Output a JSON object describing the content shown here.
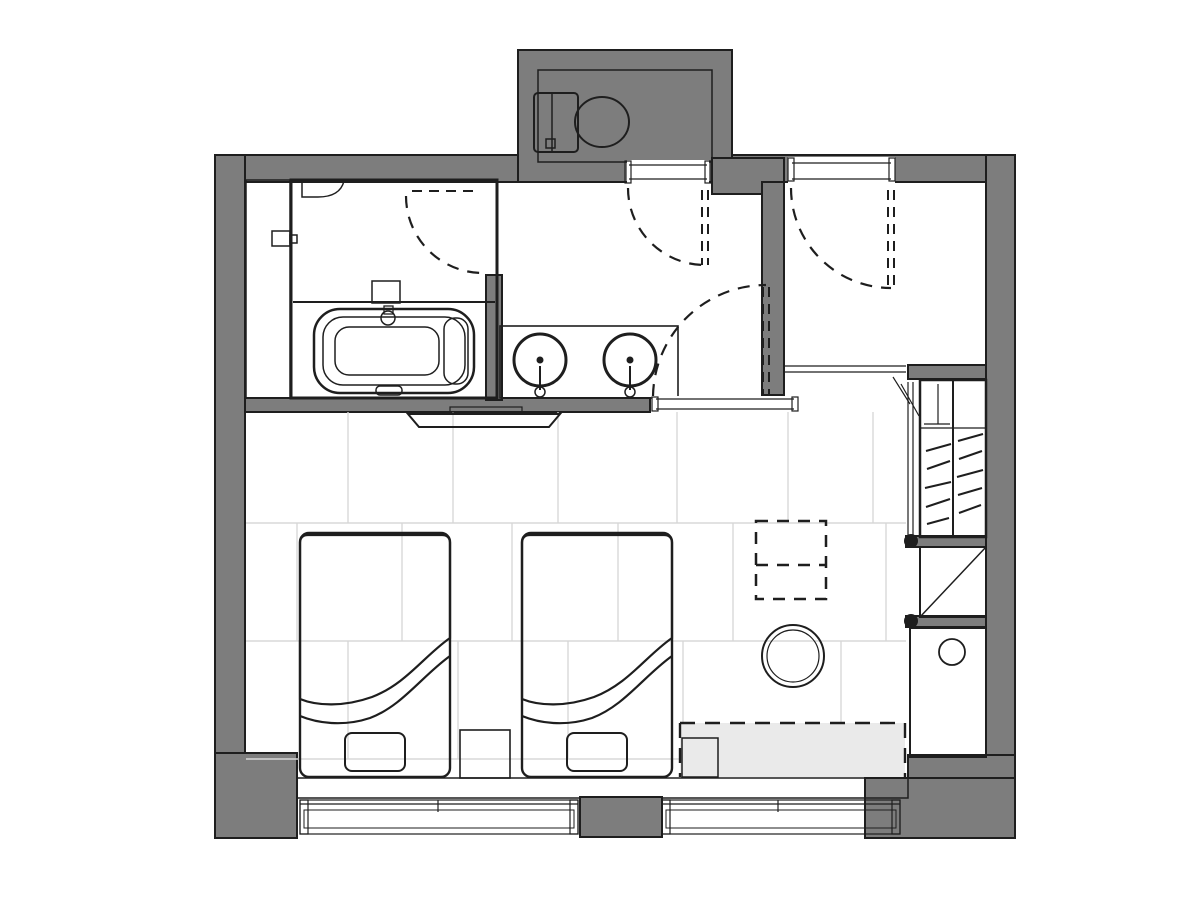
{
  "plan": {
    "kind": "hotel-guestroom-floor-plan",
    "canvas": {
      "width": 1200,
      "height": 900
    },
    "rooms": [
      {
        "name": "toilet-room"
      },
      {
        "name": "unit-bathroom-with-tub-and-shower"
      },
      {
        "name": "vanity-washroom"
      },
      {
        "name": "entry-hall"
      },
      {
        "name": "wardrobe-closet"
      },
      {
        "name": "kitchenette-counter"
      },
      {
        "name": "twin-bedroom"
      }
    ],
    "fixtures": [
      {
        "name": "toilet"
      },
      {
        "name": "bathtub"
      },
      {
        "name": "shower-control"
      },
      {
        "name": "vanity-counter-two-sinks"
      },
      {
        "name": "wall-mounted-tv"
      },
      {
        "name": "twin-bed-left"
      },
      {
        "name": "twin-bed-right"
      },
      {
        "name": "nightstand"
      },
      {
        "name": "round-table"
      },
      {
        "name": "overhead-cabinet-dashed"
      },
      {
        "name": "window-bench-dashed"
      },
      {
        "name": "clothes-hangers"
      },
      {
        "name": "luggage-rack"
      },
      {
        "name": "counter-sink"
      },
      {
        "name": "entry-door-swing"
      },
      {
        "name": "toilet-door-swing"
      },
      {
        "name": "bathroom-door-swing"
      },
      {
        "name": "vanity-door-swing"
      },
      {
        "name": "window-left"
      },
      {
        "name": "window-right"
      }
    ]
  },
  "colors": {
    "page_bg": "#ffffff",
    "wall": "#7d7d7d",
    "line": "#1e1e1e",
    "floor_light": "#eaeaea",
    "white": "#ffffff",
    "duvet": "#b5b5b5",
    "pillow": "#efefef",
    "sill": "#b4b4b4",
    "glass": "#d7d7d7",
    "grid": "#d8d8d8",
    "unit_dark": "#9a9a9a"
  }
}
